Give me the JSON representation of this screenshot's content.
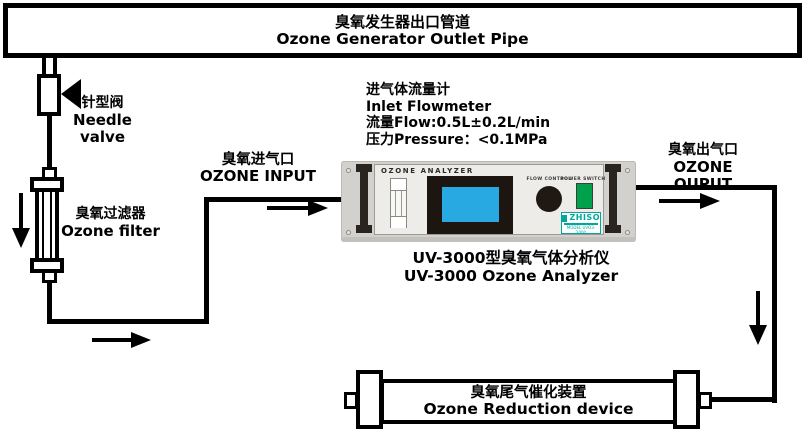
{
  "top_pipe": {
    "title_zh": "臭氧发生器出口管道",
    "title_en": "Ozone Generator Outlet Pipe"
  },
  "needle_valve": {
    "label_zh": "针型阀",
    "label_en": "Needle valve"
  },
  "ozone_filter": {
    "label_zh": "臭氧过滤器",
    "label_en": "Ozone filter"
  },
  "inlet_note": {
    "line1": "进气体流量计",
    "line2": "Inlet Flowmeter",
    "line3": "流量Flow:0.5L±0.2L/min",
    "line4": "压力Pressure：<0.1MPa"
  },
  "ozone_input": {
    "label_zh": "臭氧进气口",
    "label_en": "OZONE INPUT"
  },
  "ozone_output": {
    "label_zh": "臭氧出气口",
    "label_en": "OZONE OUPUT"
  },
  "analyzer": {
    "panel_title": "OZONE ANALYZER",
    "flow_control": "FLOW CONTROL",
    "power_switch": "POWER SWITCH",
    "brand": "ZHISO",
    "model": "MODEL UVO3-3000",
    "caption_zh": "UV-3000型臭氧气体分析仪",
    "caption_en": "UV-3000 Ozone Analyzer"
  },
  "reduction_device": {
    "label_zh": "臭氧尾气催化装置",
    "label_en": "Ozone Reduction device"
  },
  "colors": {
    "line_black": "#000000",
    "analyzer_body": "#d2d1cd",
    "analyzer_panel": "#edece8",
    "screen_blue": "#29a9e2",
    "switch_green": "#00a14b",
    "brand_teal": "#00a79d"
  }
}
